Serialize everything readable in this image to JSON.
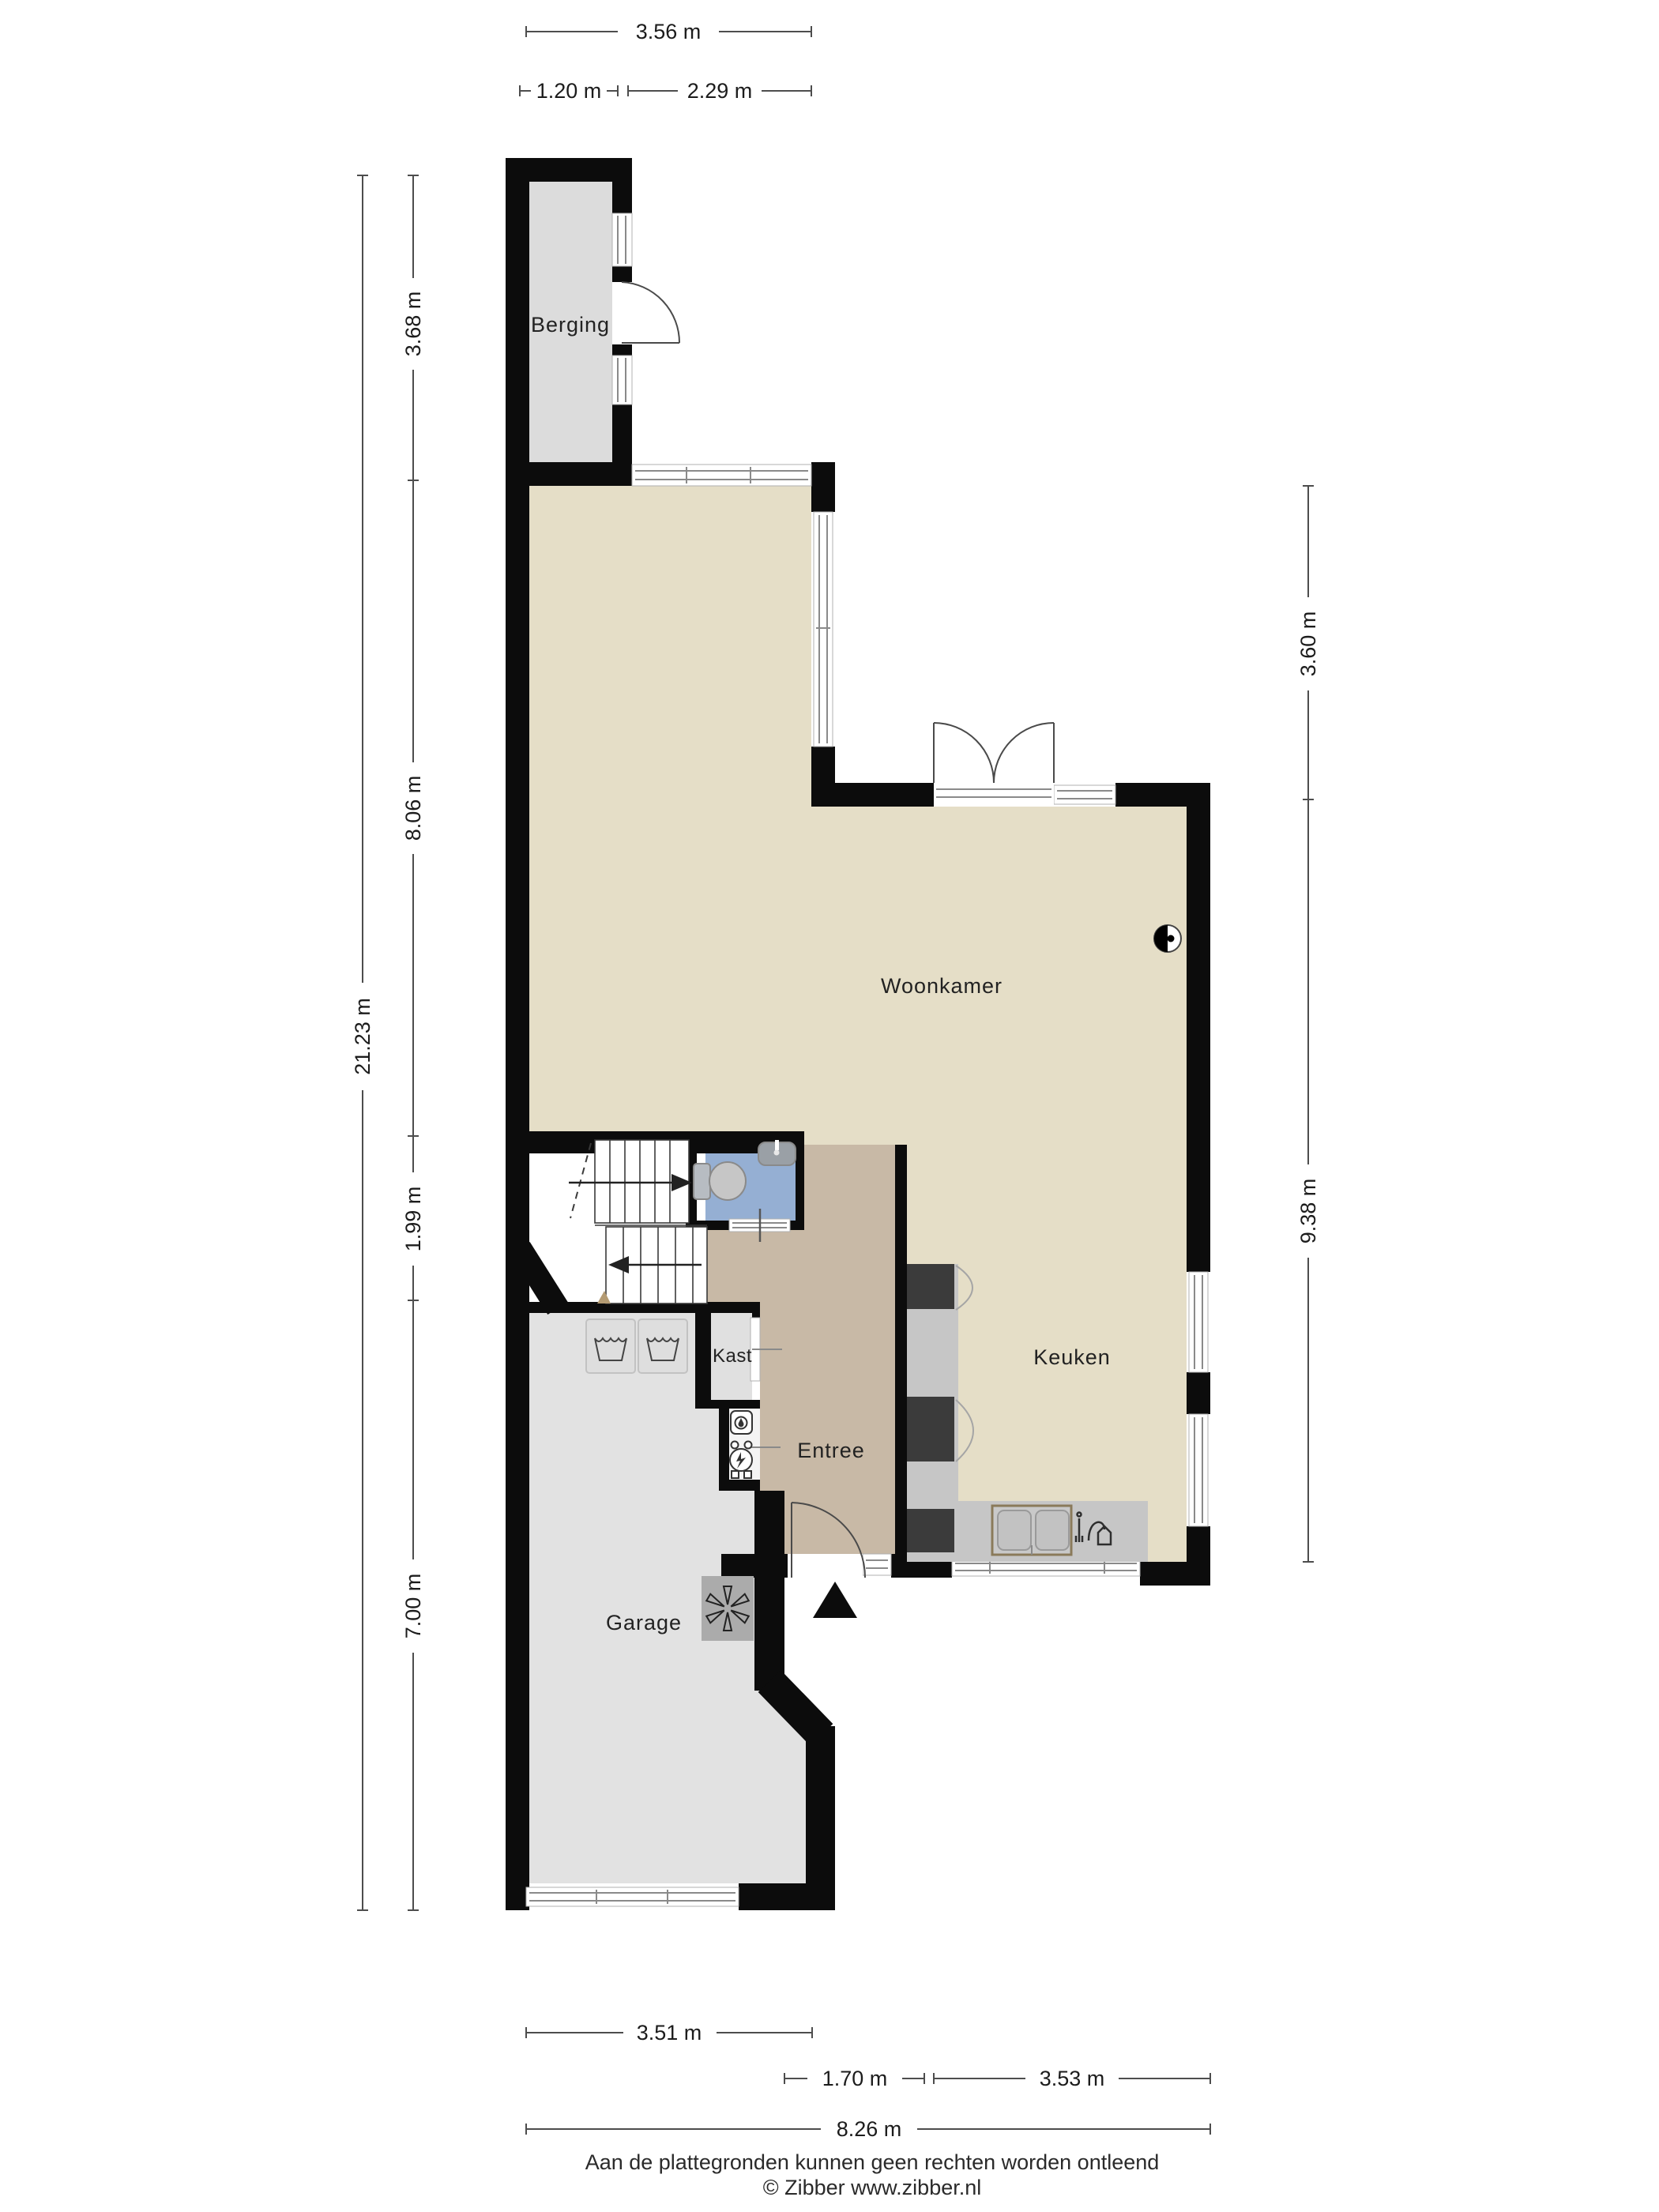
{
  "fp": {
    "rooms": {
      "berging": "Berging",
      "woonkamer": "Woonkamer",
      "keuken": "Keuken",
      "kast": "Kast",
      "entree": "Entree",
      "garage": "Garage"
    },
    "dims": {
      "top_total": "3.56 m",
      "top_berging": "1.20 m",
      "top_passage": "2.29 m",
      "left_berging": "3.68 m",
      "left_living": "8.06 m",
      "left_stairs": "1.99 m",
      "left_garage": "7.00 m",
      "left_total": "21.23 m",
      "right_upper": "3.60 m",
      "right_lower": "9.38 m",
      "bottom_garage": "3.51 m",
      "bottom_entrance": "1.70 m",
      "bottom_kitchen": "3.53 m",
      "bottom_total": "8.26 m"
    },
    "footer": {
      "disclaimer": "Aan de plattegronden kunnen geen rechten worden ontleend",
      "credit": "© Zibber www.zibber.nl"
    },
    "colors": {
      "wall": "#0c0c0c",
      "living_floor": "#e5dec7",
      "hall_floor": "#c8b9a6",
      "toilet_floor": "#95afd3",
      "berging_floor": "#dcdcdc",
      "garage_floor": "#e2e2e2",
      "kast_floor": "#e0e0e0",
      "counter": "#c6c6c6",
      "appliance": "#3b3b3b"
    }
  }
}
